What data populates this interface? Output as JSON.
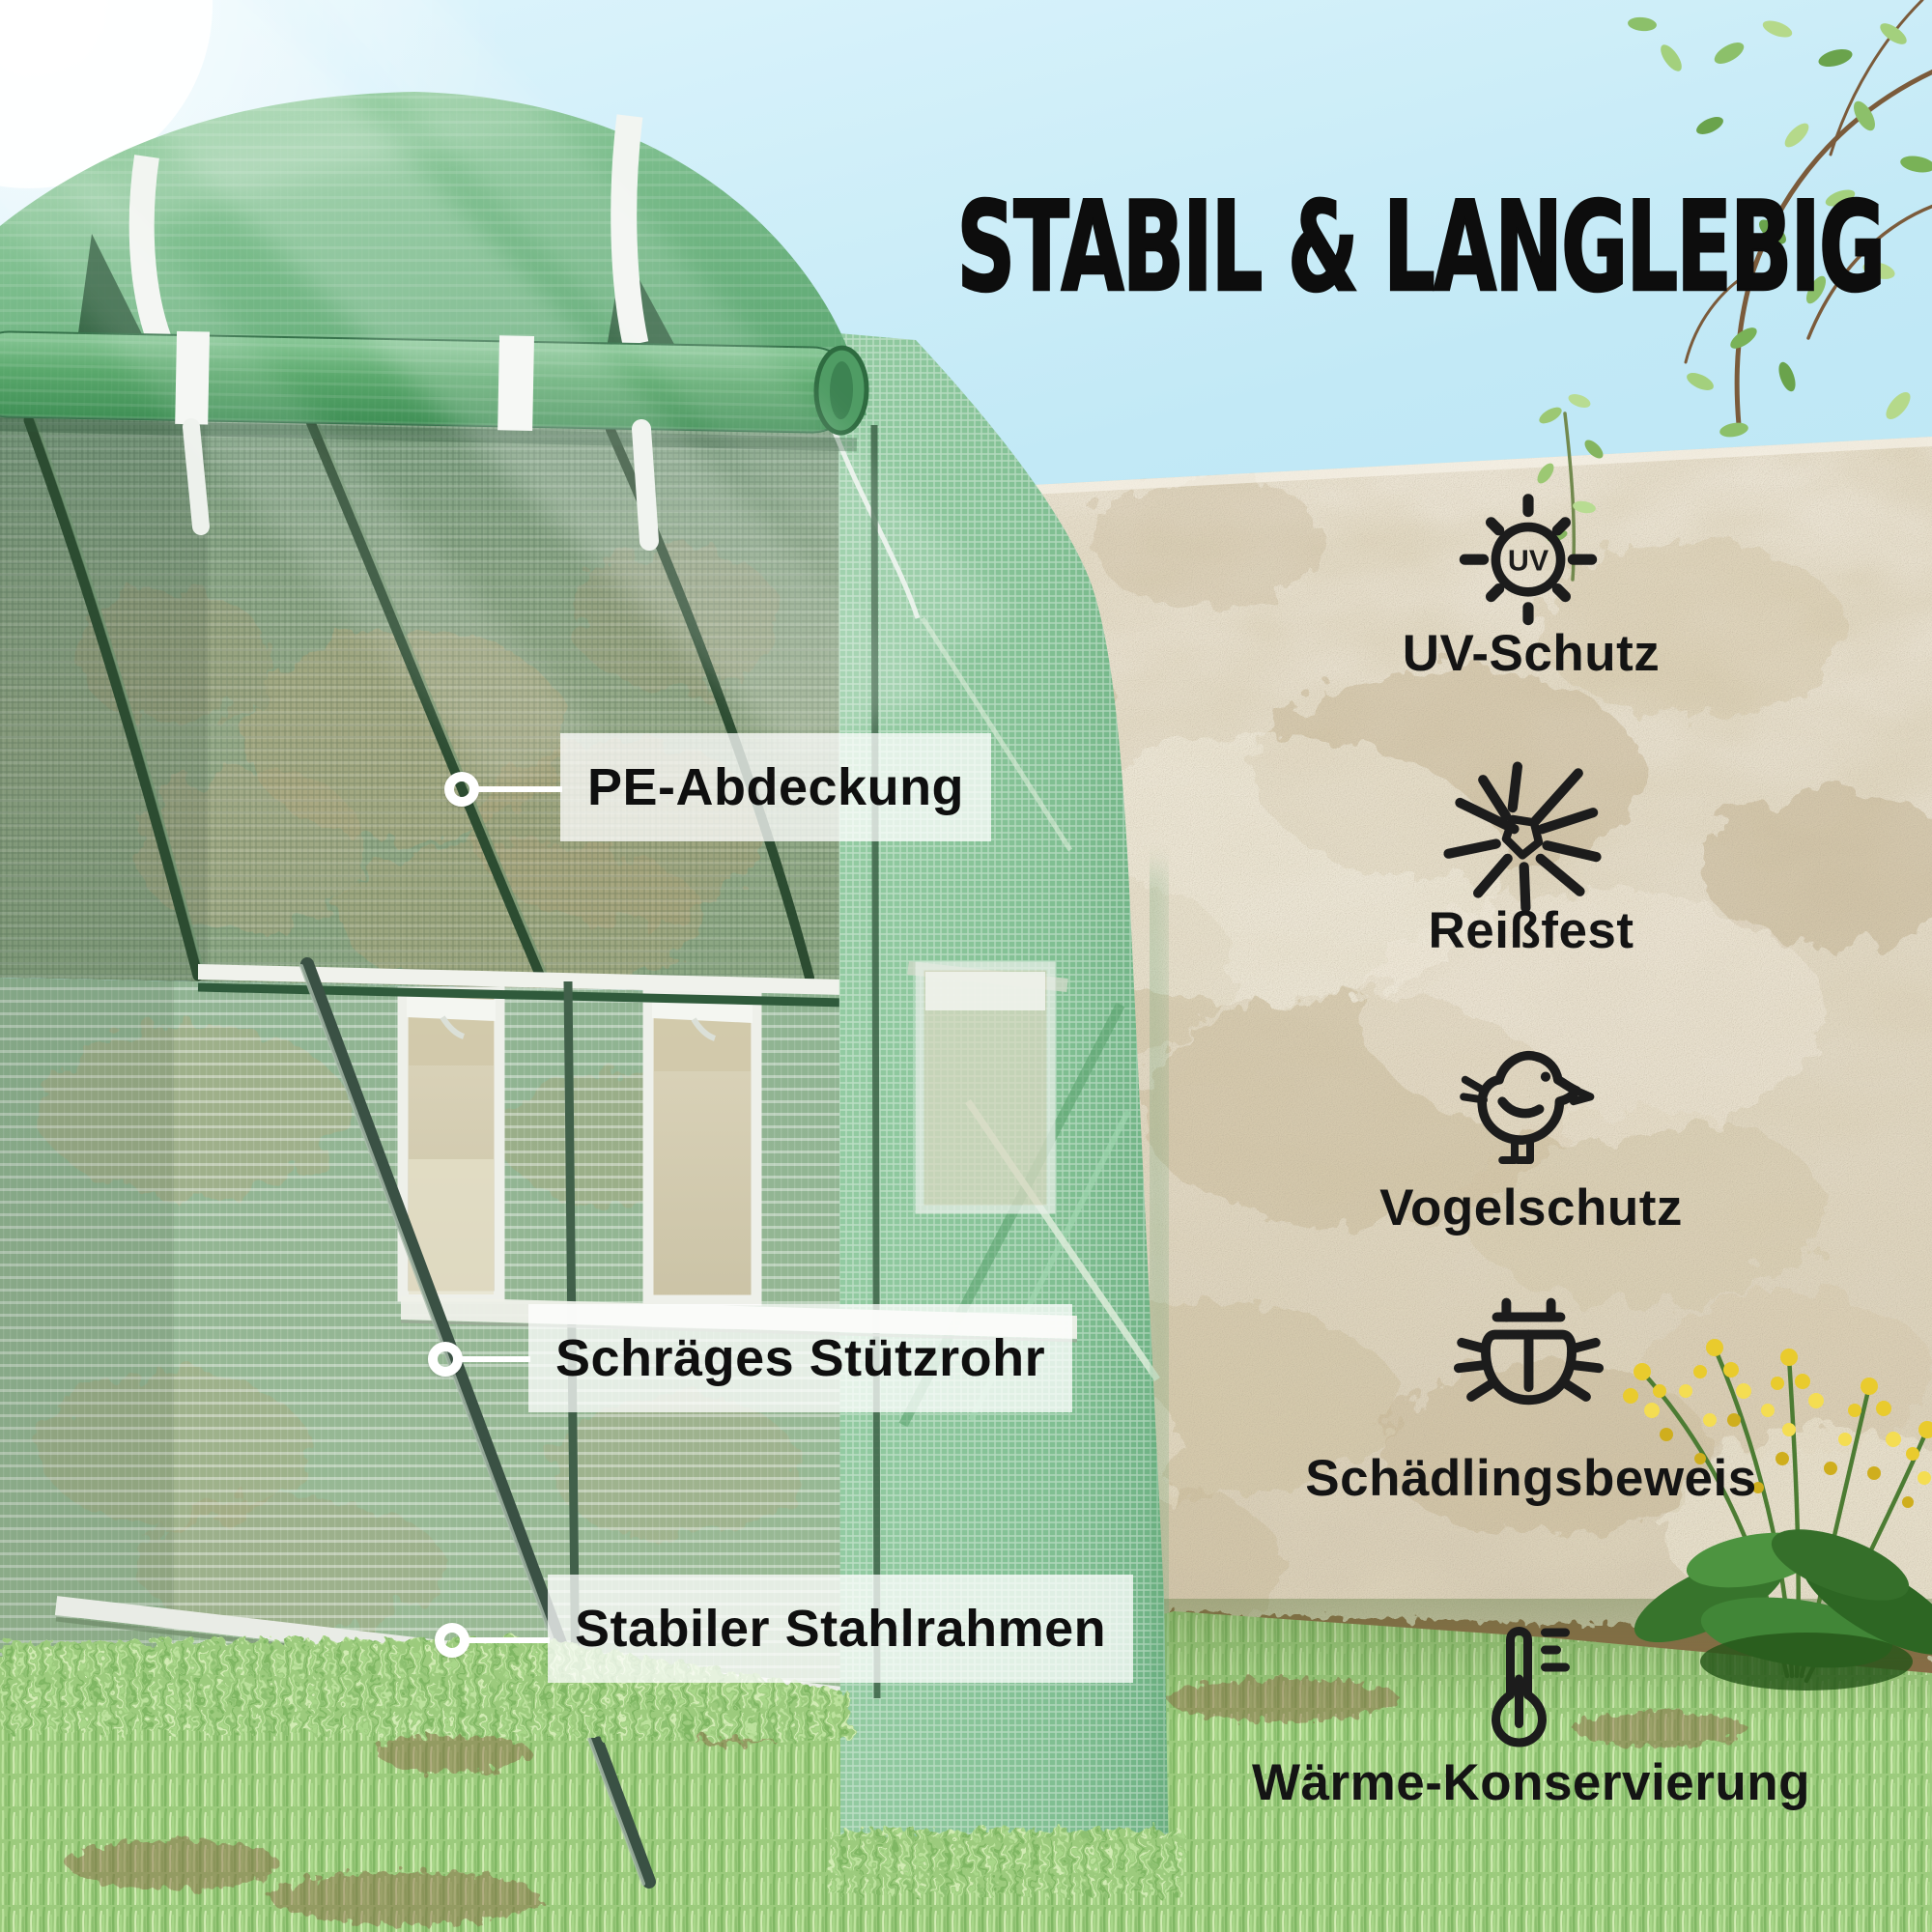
{
  "title": "STABIL & LANGLEBIG",
  "callouts": [
    {
      "label": "PE-Abdeckung"
    },
    {
      "label": "Schräges Stützrohr"
    },
    {
      "label": "Stabiler Stahlrahmen"
    }
  ],
  "features": [
    {
      "icon": "uv-sun-icon",
      "label": "UV-Schutz"
    },
    {
      "icon": "tear-resistant-icon",
      "label": "Reißfest"
    },
    {
      "icon": "bird-icon",
      "label": "Vogelschutz"
    },
    {
      "icon": "bug-icon",
      "label": "Schädlingsbeweis"
    },
    {
      "icon": "thermometer-icon",
      "label": "Wärme-Konservierung"
    }
  ],
  "uv_badge": "UV",
  "colors": {
    "sky": "#BFE7F5",
    "greenhouse_cover": "#74B786",
    "greenhouse_door": "#8EC79E",
    "wall": "#E2D9C6",
    "grass": "#9CCB7D",
    "label_background": "rgba(255,255,255,0.75)",
    "text": "#121212"
  }
}
